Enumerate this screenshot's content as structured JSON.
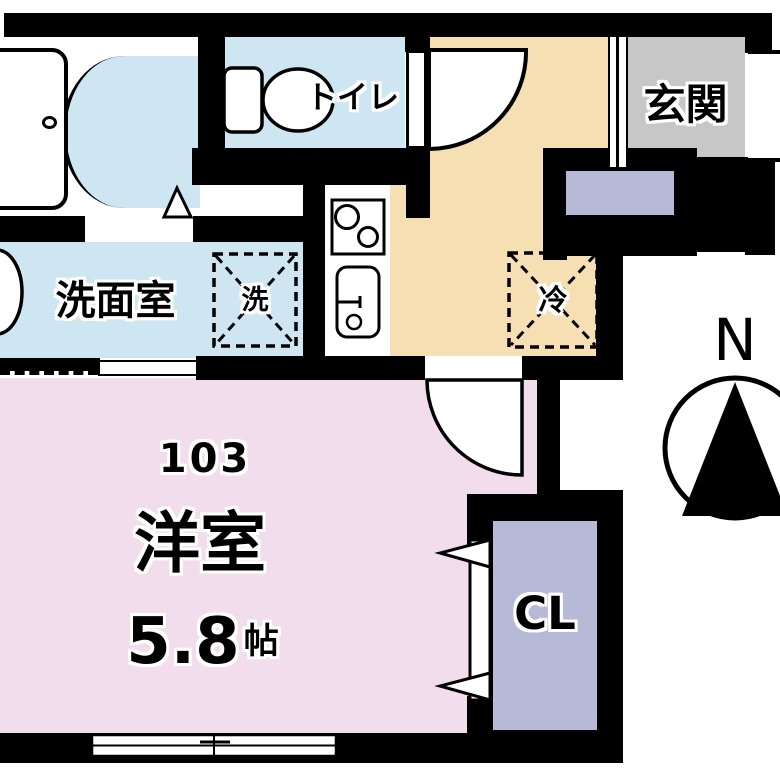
{
  "colors": {
    "wall": "#000000",
    "wet_area": "#cde6f2",
    "hallway": "#f5dfb3",
    "main_room": "#f2dded",
    "closet": "#b6bad7",
    "entry": "#c7c7c7"
  },
  "rooms": {
    "toilet": {
      "label": "トイレ"
    },
    "entry": {
      "label": "玄関"
    },
    "washroom": {
      "label": "洗面室"
    },
    "main_room": {
      "number": "103",
      "type": "洋室",
      "size": "5.8",
      "size_unit": "帖"
    },
    "closet": {
      "label": "CL"
    }
  },
  "symbols": {
    "washing_machine": "洗",
    "refrigerator": "冷",
    "compass_north": "N"
  }
}
